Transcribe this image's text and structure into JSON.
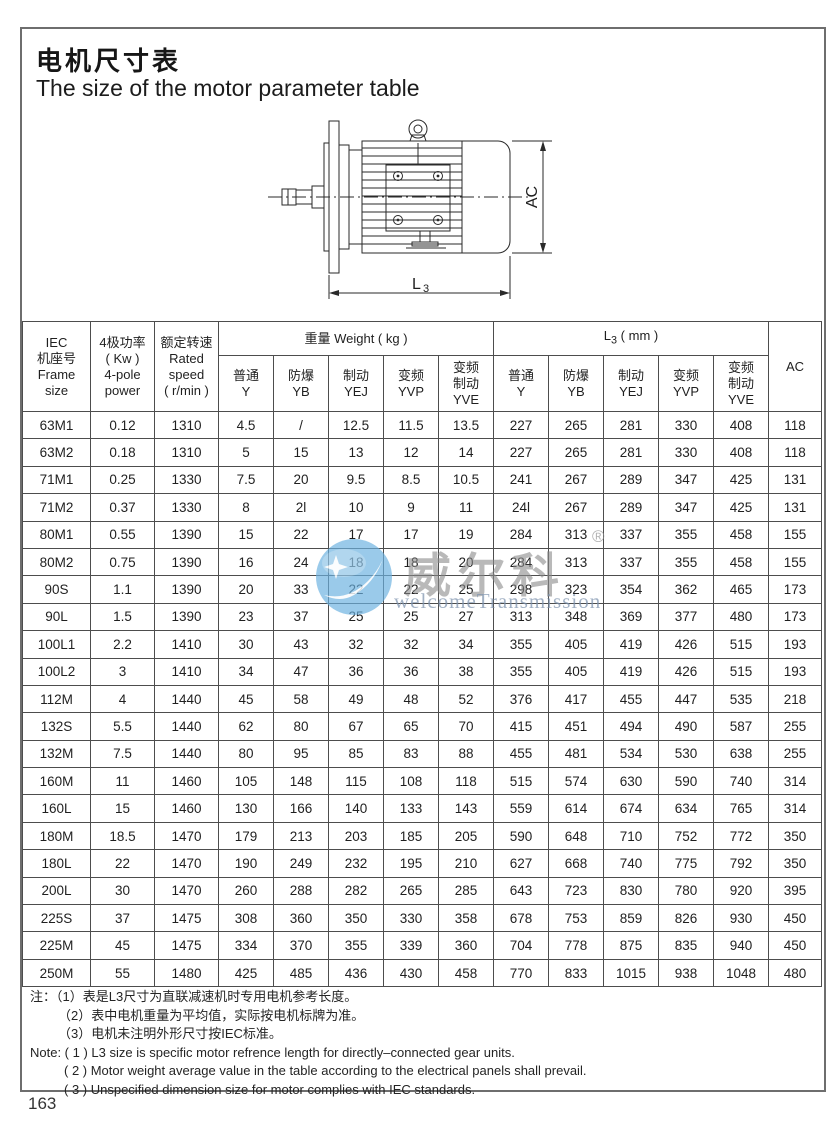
{
  "page": {
    "title_zh": "电机尺寸表",
    "title_en": "The size of the motor parameter table",
    "page_number": "163"
  },
  "drawing": {
    "dim_ac": "AC",
    "dim_l_main": "L",
    "dim_l_sub": "3"
  },
  "watermark": {
    "brand_zh": "威尔科",
    "reg_mark": "®",
    "brand_en": "welcomeTransmission",
    "logo_color": "#6cb2e0"
  },
  "table": {
    "headers": {
      "frame": "IEC\n机座号\nFrame\nsize",
      "power": "4极功率\n( Kw )\n4-pole\npower",
      "speed": "额定转速\nRated\nspeed\n( r/min )",
      "weight_group": "重量 Weight ( kg )",
      "l3_main": "L",
      "l3_sub": "3",
      "l3_unit": " ( mm )",
      "ac": "AC"
    },
    "sub_headers": [
      {
        "zh": "普通",
        "code": "Y"
      },
      {
        "zh": "防爆",
        "code": "YB"
      },
      {
        "zh": "制动",
        "code": "YEJ"
      },
      {
        "zh": "变频",
        "code": "YVP"
      },
      {
        "zh": "变频\n制动",
        "code": "YVE"
      }
    ],
    "rows": [
      [
        "63M1",
        "0.12",
        "1310",
        "4.5",
        "/",
        "12.5",
        "11.5",
        "13.5",
        "227",
        "265",
        "281",
        "330",
        "408",
        "118"
      ],
      [
        "63M2",
        "0.18",
        "1310",
        "5",
        "15",
        "13",
        "12",
        "14",
        "227",
        "265",
        "281",
        "330",
        "408",
        "118"
      ],
      [
        "71M1",
        "0.25",
        "1330",
        "7.5",
        "20",
        "9.5",
        "8.5",
        "10.5",
        "241",
        "267",
        "289",
        "347",
        "425",
        "131"
      ],
      [
        "71M2",
        "0.37",
        "1330",
        "8",
        "2l",
        "10",
        "9",
        "11",
        "24l",
        "267",
        "289",
        "347",
        "425",
        "131"
      ],
      [
        "80M1",
        "0.55",
        "1390",
        "15",
        "22",
        "17",
        "17",
        "19",
        "284",
        "313",
        "337",
        "355",
        "458",
        "155"
      ],
      [
        "80M2",
        "0.75",
        "1390",
        "16",
        "24",
        "18",
        "18",
        "20",
        "284",
        "313",
        "337",
        "355",
        "458",
        "155"
      ],
      [
        "90S",
        "1.1",
        "1390",
        "20",
        "33",
        "22",
        "22",
        "25",
        "298",
        "323",
        "354",
        "362",
        "465",
        "173"
      ],
      [
        "90L",
        "1.5",
        "1390",
        "23",
        "37",
        "25",
        "25",
        "27",
        "313",
        "348",
        "369",
        "377",
        "480",
        "173"
      ],
      [
        "100L1",
        "2.2",
        "1410",
        "30",
        "43",
        "32",
        "32",
        "34",
        "355",
        "405",
        "419",
        "426",
        "515",
        "193"
      ],
      [
        "100L2",
        "3",
        "1410",
        "34",
        "47",
        "36",
        "36",
        "38",
        "355",
        "405",
        "419",
        "426",
        "515",
        "193"
      ],
      [
        "112M",
        "4",
        "1440",
        "45",
        "58",
        "49",
        "48",
        "52",
        "376",
        "417",
        "455",
        "447",
        "535",
        "218"
      ],
      [
        "132S",
        "5.5",
        "1440",
        "62",
        "80",
        "67",
        "65",
        "70",
        "415",
        "451",
        "494",
        "490",
        "587",
        "255"
      ],
      [
        "132M",
        "7.5",
        "1440",
        "80",
        "95",
        "85",
        "83",
        "88",
        "455",
        "481",
        "534",
        "530",
        "638",
        "255"
      ],
      [
        "160M",
        "11",
        "1460",
        "105",
        "148",
        "115",
        "108",
        "118",
        "515",
        "574",
        "630",
        "590",
        "740",
        "314"
      ],
      [
        "160L",
        "15",
        "1460",
        "130",
        "166",
        "140",
        "133",
        "143",
        "559",
        "614",
        "674",
        "634",
        "765",
        "314"
      ],
      [
        "180M",
        "18.5",
        "1470",
        "179",
        "213",
        "203",
        "185",
        "205",
        "590",
        "648",
        "710",
        "752",
        "772",
        "350"
      ],
      [
        "180L",
        "22",
        "1470",
        "190",
        "249",
        "232",
        "195",
        "210",
        "627",
        "668",
        "740",
        "775",
        "792",
        "350"
      ],
      [
        "200L",
        "30",
        "1470",
        "260",
        "288",
        "282",
        "265",
        "285",
        "643",
        "723",
        "830",
        "780",
        "920",
        "395"
      ],
      [
        "225S",
        "37",
        "1475",
        "308",
        "360",
        "350",
        "330",
        "358",
        "678",
        "753",
        "859",
        "826",
        "930",
        "450"
      ],
      [
        "225M",
        "45",
        "1475",
        "334",
        "370",
        "355",
        "339",
        "360",
        "704",
        "778",
        "875",
        "835",
        "940",
        "450"
      ],
      [
        "250M",
        "55",
        "1480",
        "425",
        "485",
        "436",
        "430",
        "458",
        "770",
        "833",
        "1015",
        "938",
        "1048",
        "480"
      ]
    ]
  },
  "notes": {
    "zh": [
      "注：（1）表是L3尺寸为直联减速机时专用电机参考长度。",
      "（2）表中电机重量为平均值，实际按电机标牌为准。",
      "（3）电机未注明外形尺寸按IEC标准。"
    ],
    "en": [
      "Note: ( 1 ) L3 size is specific motor refrence length for directly–connected gear units.",
      "( 2 ) Motor weight average value in the table according to the electrical panels shall prevail.",
      "( 3 ) Unspecified dimension size for motor complies with IEC standards."
    ]
  }
}
